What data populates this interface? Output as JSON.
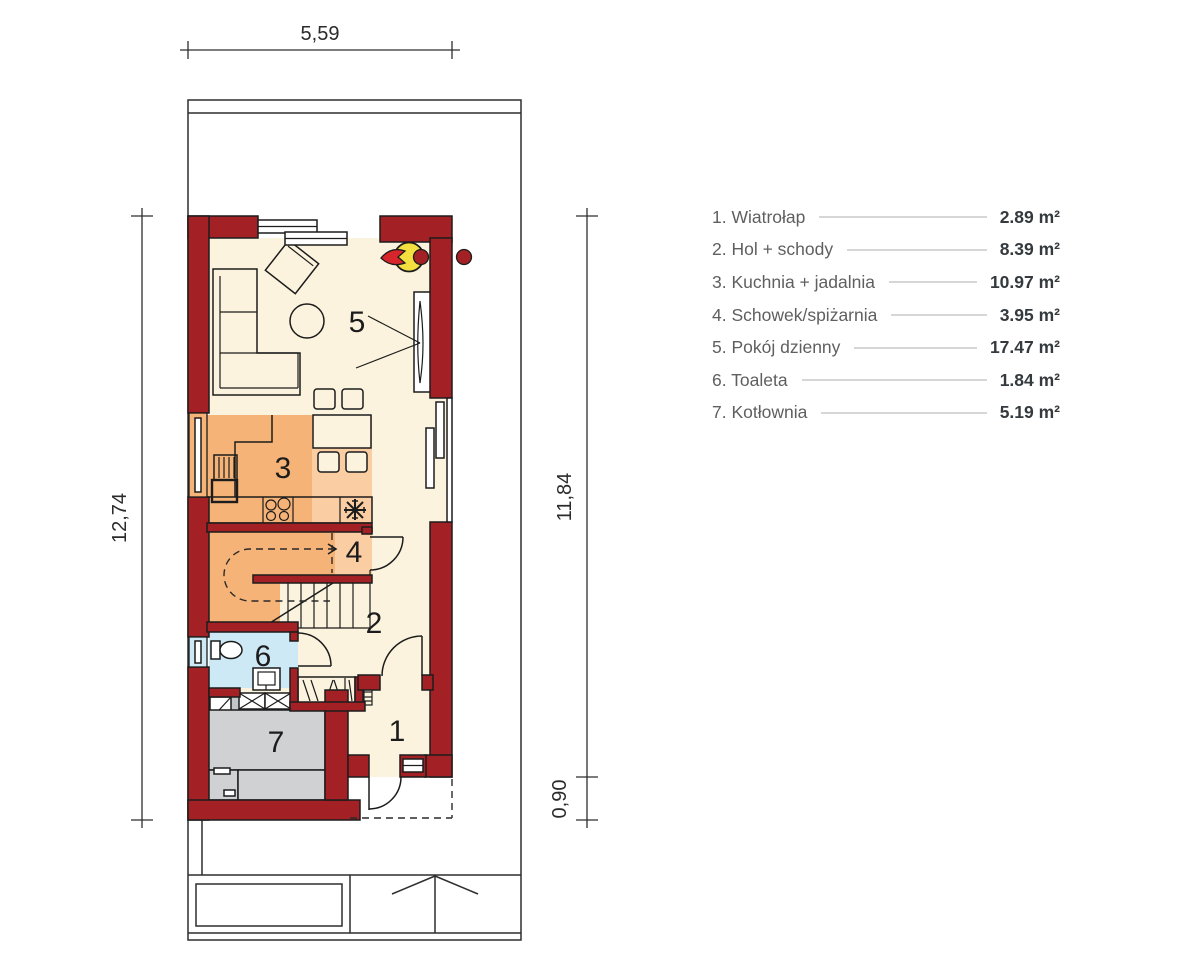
{
  "rooms": [
    {
      "number": "1",
      "label": "1. Wiatrołap",
      "area": "2.89 m²"
    },
    {
      "number": "2",
      "label": "2. Hol + schody",
      "area": "8.39 m²"
    },
    {
      "number": "3",
      "label": "3. Kuchnia + jadalnia",
      "area": "10.97 m²"
    },
    {
      "number": "4",
      "label": "4. Schowek/spiżarnia",
      "area": "3.95 m²"
    },
    {
      "number": "5",
      "label": "5. Pokój dzienny",
      "area": "17.47 m²"
    },
    {
      "number": "6",
      "label": "6. Toaleta",
      "area": "1.84 m²"
    },
    {
      "number": "7",
      "label": "7. Kotłownia",
      "area": "5.19 m²"
    }
  ],
  "dimensions": {
    "width_top": "5,59",
    "height_left": "12,74",
    "height_right": "11,84",
    "porch_right": "0,90"
  },
  "colors": {
    "wall": "#A32124",
    "flame": "#D6252B",
    "fire_yellow": "#F3DF3F",
    "cream": "#FBF3DE",
    "orange": "#F6B377",
    "orange_light": "#FACDA2",
    "blue": "#CEE9F6",
    "gray_floor": "#C3C6C8",
    "gray_equip": "#CFD1D3",
    "outline": "#1C1C1C",
    "dash": "#2A2A2A",
    "legend_label": "#5F5F5F",
    "legend_value": "#343A3E",
    "leader": "#D6D6D6"
  }
}
